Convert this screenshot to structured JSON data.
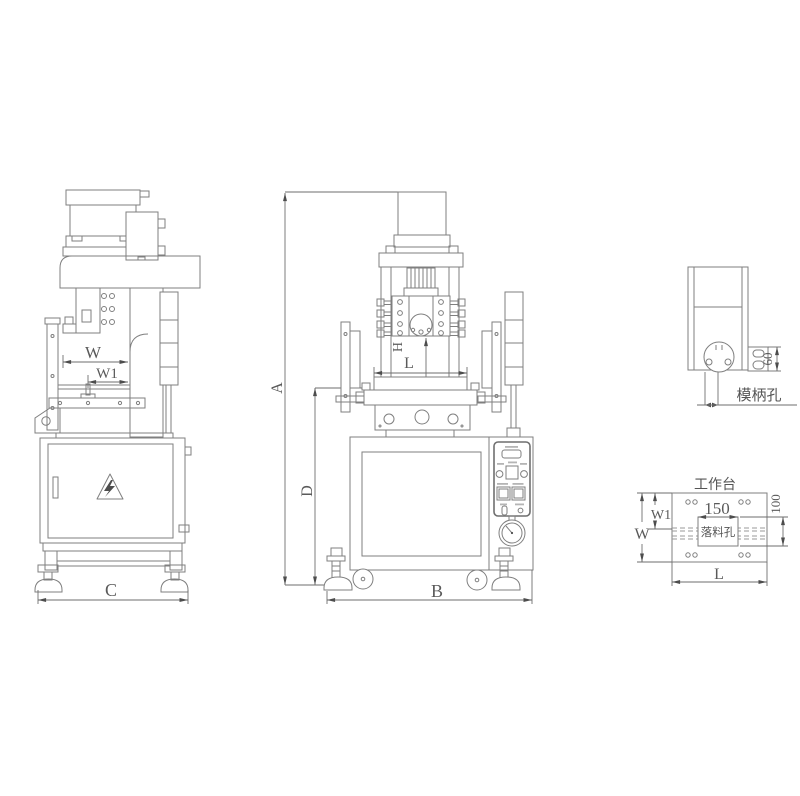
{
  "colors": {
    "background": "#ffffff",
    "line": "#7f7f7f",
    "text": "#5a5a5a",
    "arrow": "#4d4d4d"
  },
  "side_view": {
    "dim_w": "W",
    "dim_w1": "W1",
    "dim_c": "C"
  },
  "front_view": {
    "dim_a": "A",
    "dim_d": "D",
    "dim_h": "H",
    "dim_l": "L",
    "dim_b": "B"
  },
  "ram_detail": {
    "label_shank_hole": "模柄孔",
    "dim_height": "60"
  },
  "worktable": {
    "title": "工作台",
    "label_hole": "落料孔",
    "dim_width": "150",
    "dim_height": "100",
    "dim_w": "W",
    "dim_w1": "W1",
    "dim_l": "L"
  }
}
